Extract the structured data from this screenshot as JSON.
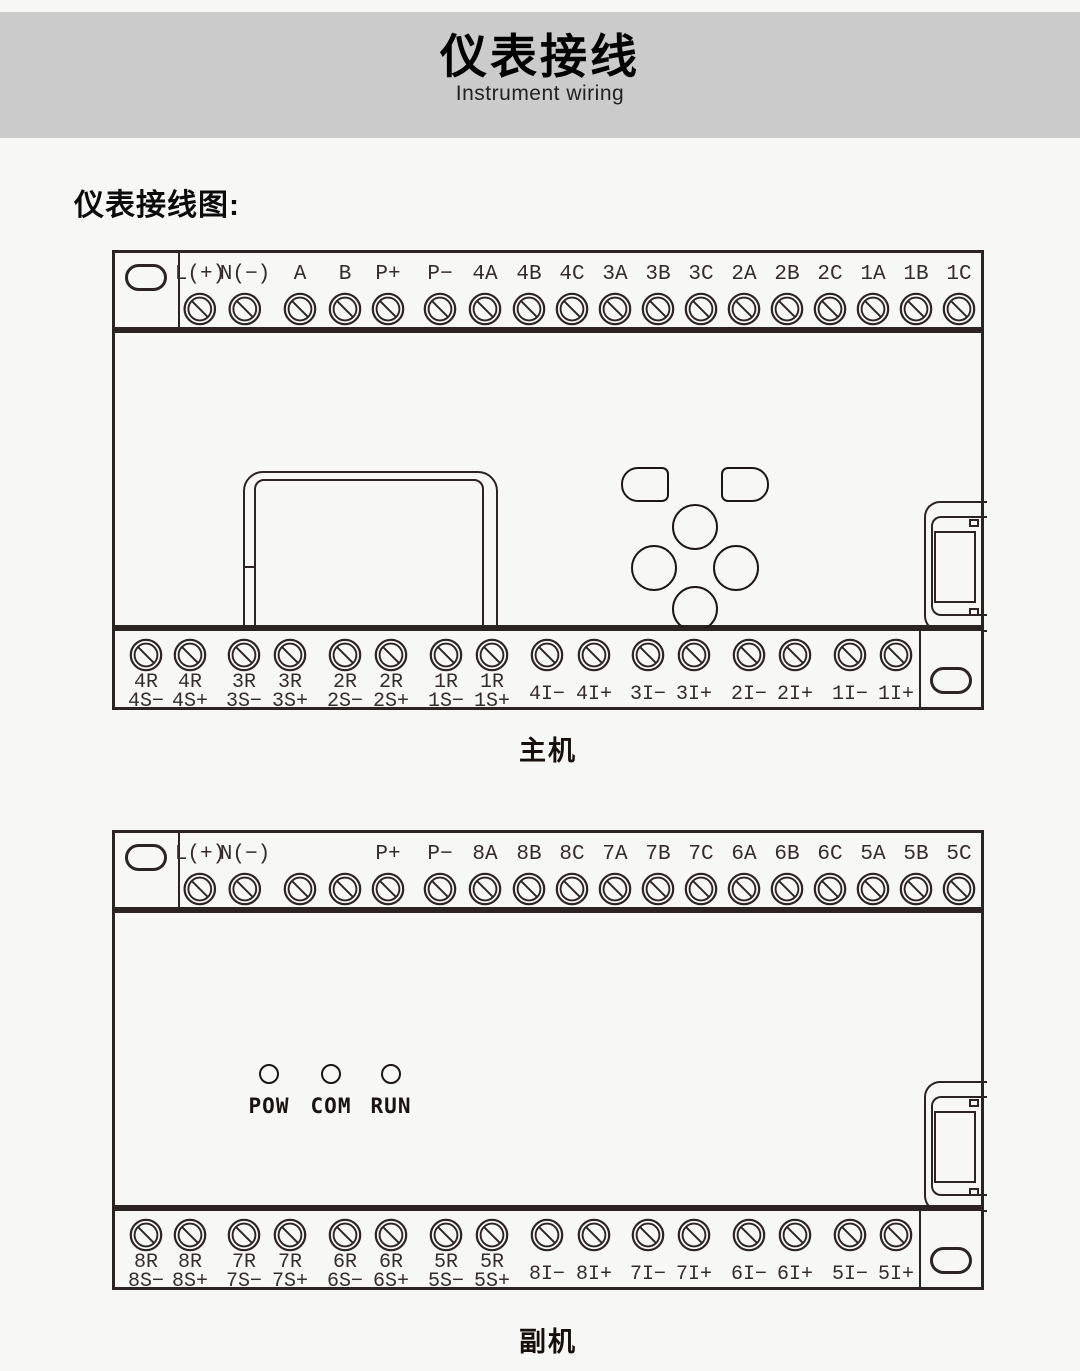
{
  "banner": {
    "title": "仪表接线",
    "subtitle": "Instrument wiring"
  },
  "section_heading": "仪表接线图:",
  "colors": {
    "banner_bg": "#cbcbcb",
    "line": "#2b2423",
    "page_bg": "#f7f7f6"
  },
  "main_unit": {
    "caption": "主机",
    "top_terminals": [
      "L(+)",
      "N(−)",
      "A",
      "B",
      "P+",
      "P−",
      "4A",
      "4B",
      "4C",
      "3A",
      "3B",
      "3C",
      "2A",
      "2B",
      "2C",
      "1A",
      "1B",
      "1C"
    ],
    "bottom_terminals": [
      [
        "4R",
        "4S−"
      ],
      [
        "4R",
        "4S+"
      ],
      [
        "3R",
        "3S−"
      ],
      [
        "3R",
        "3S+"
      ],
      [
        "2R",
        "2S−"
      ],
      [
        "2R",
        "2S+"
      ],
      [
        "1R",
        "1S−"
      ],
      [
        "1R",
        "1S+"
      ],
      [
        "4I−"
      ],
      [
        "4I+"
      ],
      [
        "3I−"
      ],
      [
        "3I+"
      ],
      [
        "2I−"
      ],
      [
        "2I+"
      ],
      [
        "1I−"
      ],
      [
        "1I+"
      ]
    ]
  },
  "sub_unit": {
    "caption": "副机",
    "top_terminals": [
      "L(+)",
      "N(−)",
      "",
      "",
      "P+",
      "P−",
      "8A",
      "8B",
      "8C",
      "7A",
      "7B",
      "7C",
      "6A",
      "6B",
      "6C",
      "5A",
      "5B",
      "5C"
    ],
    "leds": [
      "POW",
      "COM",
      "RUN"
    ],
    "bottom_terminals": [
      [
        "8R",
        "8S−"
      ],
      [
        "8R",
        "8S+"
      ],
      [
        "7R",
        "7S−"
      ],
      [
        "7R",
        "7S+"
      ],
      [
        "6R",
        "6S−"
      ],
      [
        "6R",
        "6S+"
      ],
      [
        "5R",
        "5S−"
      ],
      [
        "5R",
        "5S+"
      ],
      [
        "8I−"
      ],
      [
        "8I+"
      ],
      [
        "7I−"
      ],
      [
        "7I+"
      ],
      [
        "6I−"
      ],
      [
        "6I+"
      ],
      [
        "5I−"
      ],
      [
        "5I+"
      ]
    ]
  }
}
